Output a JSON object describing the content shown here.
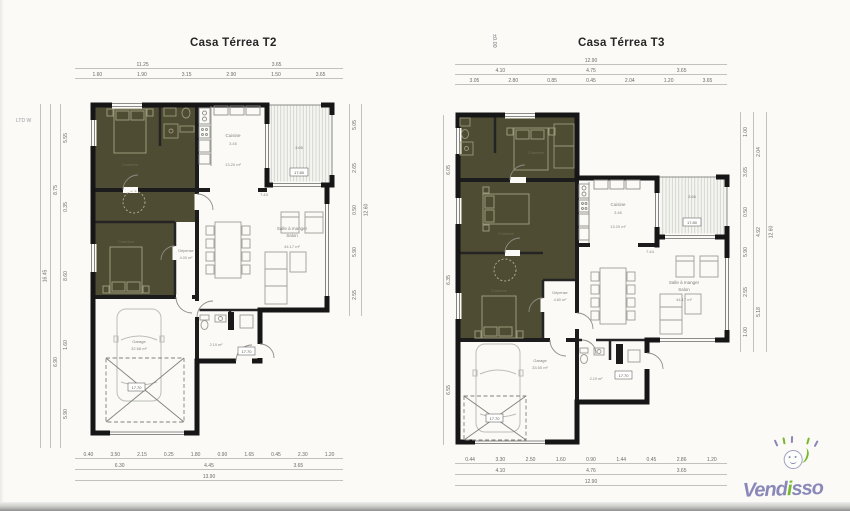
{
  "plans": {
    "t2": {
      "title": "Casa Térrea T2",
      "corner_marker": "LTD W",
      "rooms": {
        "cuisine": {
          "name": "Cuisine",
          "dim": "3.45",
          "area": "13.20 m²"
        },
        "salon": {
          "name1": "Salle à manger",
          "name2": "Salon",
          "area": "44.17 m²"
        },
        "garage": {
          "name": "Garage",
          "area": "32.68 m²"
        },
        "depense": {
          "name": "Dépense",
          "area": "4.00 m²"
        },
        "wc": {
          "area": "2.19 m²"
        },
        "chambre": {
          "name": "Chambre"
        },
        "living_width": "7.43"
      },
      "tags": {
        "terrace": "17.80",
        "terrace_dim": "3.65",
        "wc": "17.70",
        "garage": "17.70"
      },
      "dims": {
        "top1": [
          "11.25",
          "3.65"
        ],
        "top2": [
          "1.60",
          "1.90",
          "3.15",
          "2.90",
          "1.50",
          "3.65"
        ],
        "bottom1": [
          "0.40",
          "3.50",
          "2.15",
          "0.25",
          "1.80",
          "0.90",
          "1.65",
          "0.45",
          "2.30",
          "1.20"
        ],
        "bottom2": [
          "6.30",
          "4.45",
          "3.65"
        ],
        "bottom3": [
          "13.90"
        ],
        "left1": [
          "5.55",
          "0.35",
          "8.60",
          "1.60",
          "5.90"
        ],
        "left2": [
          "8.75",
          "6.90"
        ],
        "left3": [
          "16.45"
        ],
        "right1": [
          "5.05",
          "2.65",
          "0.50",
          "5.90",
          "2.55"
        ],
        "right2": [
          "12.60"
        ]
      }
    },
    "t3": {
      "title": "Casa Térrea T3",
      "level_marker": "±0.00",
      "rooms": {
        "cuisine": {
          "name": "Cuisine",
          "dim": "3.46",
          "area": "13.20 m²"
        },
        "salon": {
          "name1": "Salle à manger",
          "name2": "Salon",
          "area": "44.17 m²"
        },
        "garage": {
          "name": "Garage",
          "area": "33.50 m²"
        },
        "depense": {
          "name": "Dépense",
          "area": "4.80 m²"
        },
        "wc": {
          "area": "2.19 m²"
        },
        "chambre": {
          "name": "Chambre"
        },
        "living_width": "7.44"
      },
      "tags": {
        "terrace": "17.80",
        "terrace_dim": "3.65",
        "wc": "17.70",
        "garage": "17.70"
      },
      "dims": {
        "top1": [
          "12.90"
        ],
        "top2": [
          "4.10",
          "4.75",
          "3.65"
        ],
        "top3": [
          "3.05",
          "2.80",
          "0.85",
          "0.45",
          "2.04",
          "1.20",
          "3.65"
        ],
        "bottom1": [
          "0.44",
          "3.30",
          "2.50",
          "1.60",
          "0.90",
          "1.44",
          "0.45",
          "2.86",
          "1.20"
        ],
        "bottom2": [
          "4.10",
          "4.76",
          "3.65"
        ],
        "bottom3": [
          "12.90"
        ],
        "left1": [
          "6.05",
          "6.35",
          "6.55"
        ],
        "right1": [
          "1.00",
          "3.65",
          "0.50",
          "5.90",
          "2.55",
          "1.00"
        ],
        "right2": [
          "2.04",
          "4.92",
          "5.18"
        ],
        "right3": [
          "12.60"
        ]
      }
    }
  },
  "logo": {
    "part1": "Vend",
    "part2": "i",
    "part3": "sso"
  },
  "colors": {
    "olive": "#4e4c32",
    "wall": "#161616",
    "logo_purple": "#8a88b8",
    "logo_green": "#76b82a"
  }
}
